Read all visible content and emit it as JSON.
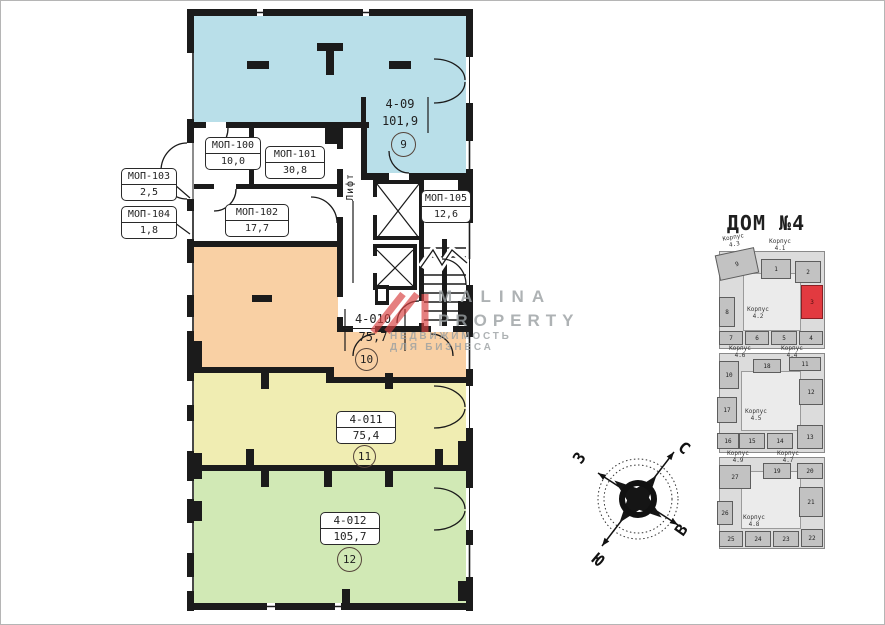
{
  "plan": {
    "units": [
      {
        "code": "4-09",
        "area": "101,9",
        "circle": "9"
      },
      {
        "code": "4-010",
        "area": "75,7",
        "circle": "10"
      },
      {
        "code": "4-011",
        "area": "75,4",
        "circle": "11"
      },
      {
        "code": "4-012",
        "area": "105,7",
        "circle": "12"
      }
    ],
    "rooms": [
      {
        "code": "МОП-100",
        "area": "10,0"
      },
      {
        "code": "МОП-101",
        "area": "30,8"
      },
      {
        "code": "МОП-102",
        "area": "17,7"
      },
      {
        "code": "МОП-103",
        "area": "2,5"
      },
      {
        "code": "МОП-104",
        "area": "1,8"
      },
      {
        "code": "МОП-105",
        "area": "12,6"
      }
    ],
    "lift": "Лифт"
  },
  "watermark": {
    "brand_line1": "MALINA",
    "brand_line2": "PROPERTY",
    "tagline": "НЕДВИЖИМОСТЬ ДЛЯ БИЗНЕСА"
  },
  "compass": {
    "n": "С",
    "s": "Ю",
    "w": "З",
    "e": "В"
  },
  "minimap": {
    "title": "ДОМ №4",
    "korpus": [
      "Корпус 4.3",
      "Корпус 4.1",
      "Корпус 4.2",
      "Корпус 4.6",
      "Корпус 4.4",
      "Корпус 4.5",
      "Корпус 4.9",
      "Корпус 4.7",
      "Корпус 4.8"
    ],
    "tiles": [
      "9",
      "1",
      "2",
      "3",
      "4",
      "5",
      "6",
      "7",
      "8",
      "10",
      "18",
      "11",
      "12",
      "13",
      "14",
      "15",
      "16",
      "17",
      "27",
      "19",
      "20",
      "21",
      "22",
      "23",
      "24",
      "25",
      "26"
    ],
    "highlight_tile": "3"
  },
  "colors": {
    "unit_409": "#b9dfe9",
    "unit_4010": "#f9d0a4",
    "unit_4011": "#f0edb2",
    "unit_4012": "#d1e9b5",
    "highlight": "#e23a40",
    "watermark_gray": "#9aa0a2",
    "watermark_red": "#d84343"
  }
}
